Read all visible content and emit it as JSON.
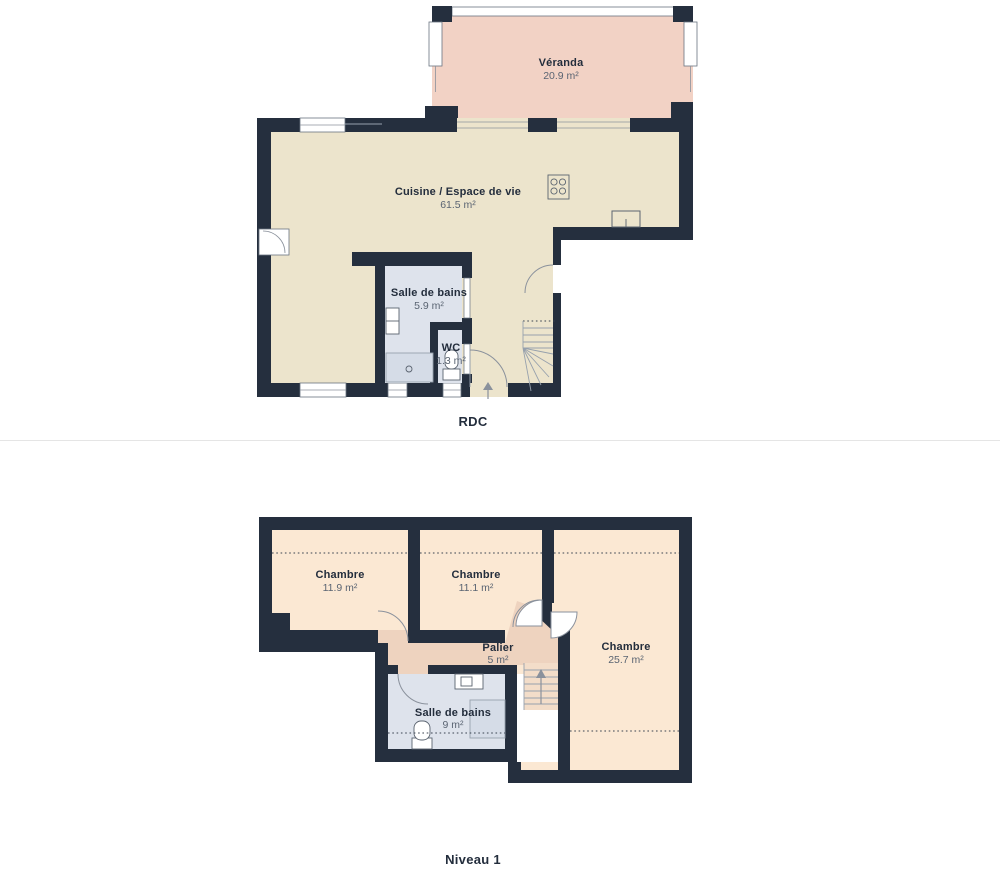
{
  "page": {
    "background": "#ffffff",
    "divider_color": "#e5e5e5"
  },
  "palette": {
    "wall": "#252f3e",
    "floor": "#ece4cc",
    "veranda": "#f2d2c5",
    "bedroom": "#fbe8d3",
    "palier": "#eed3bf",
    "bathroom": "#dee3ec",
    "stair": "#f3ddc9",
    "room_name_text": "#232d3c",
    "room_area_text": "#5a6472"
  },
  "floors": [
    {
      "id": "rdc",
      "label": "RDC",
      "rooms": [
        {
          "name": "Véranda",
          "area": "20.9 m²"
        },
        {
          "name": "Cuisine / Espace de vie",
          "area": "61.5 m²"
        },
        {
          "name": "Salle de bains",
          "area": "5.9 m²"
        },
        {
          "name": "WC",
          "area": "1.3 m²"
        }
      ],
      "features": [
        "stove",
        "kitchen-sink",
        "bath-sink",
        "shower",
        "toilet",
        "winder-stairs",
        "entrance-arrow",
        "windows",
        "door-arcs",
        "veranda-glazing"
      ]
    },
    {
      "id": "niveau1",
      "label": "Niveau 1",
      "rooms": [
        {
          "name": "Chambre",
          "area": "11.9 m²"
        },
        {
          "name": "Chambre",
          "area": "11.1 m²"
        },
        {
          "name": "Chambre",
          "area": "25.7 m²"
        },
        {
          "name": "Palier",
          "area": "5 m²"
        },
        {
          "name": "Salle de bains",
          "area": "9 m²"
        }
      ],
      "features": [
        "sink",
        "toilet",
        "shower",
        "stairs-with-arrow",
        "ceiling-height-dotted-lines",
        "door-arcs"
      ]
    }
  ]
}
